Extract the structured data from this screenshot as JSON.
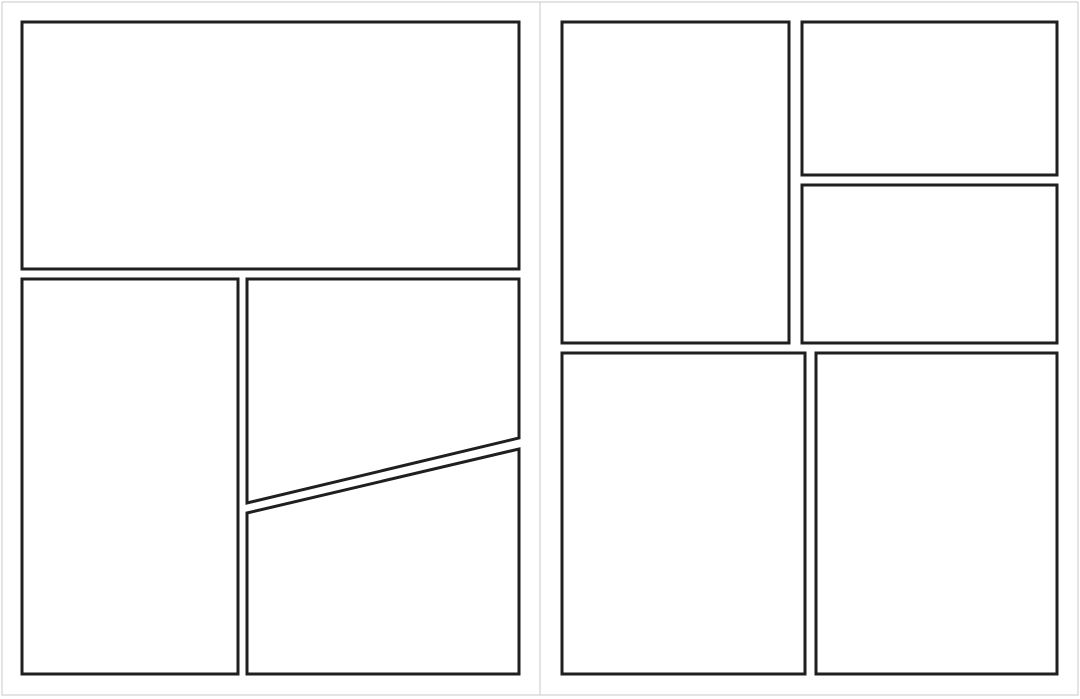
{
  "canvas": {
    "width": 1080,
    "height": 699,
    "background": "#ffffff"
  },
  "colors": {
    "page_background": "#ffffff",
    "page_outline": "#c8c8c8",
    "panel_fill": "#ffffff",
    "panel_border": "#1f1f1f"
  },
  "strokes": {
    "page_outline_width": 1,
    "panel_border_width": 3
  },
  "pages": [
    {
      "id": "page-left",
      "frame": {
        "x": 2,
        "y": 2,
        "w": 538,
        "h": 693
      },
      "panels": [
        {
          "id": "panel-left-top-banner",
          "shape": "rect",
          "points": [
            [
              22,
              22
            ],
            [
              519,
              22
            ],
            [
              519,
              269
            ],
            [
              22,
              269
            ]
          ]
        },
        {
          "id": "panel-left-bottom-left",
          "shape": "rect",
          "points": [
            [
              22,
              279
            ],
            [
              238,
              279
            ],
            [
              238,
              674
            ],
            [
              22,
              674
            ]
          ]
        },
        {
          "id": "panel-left-diagonal-upper",
          "shape": "polygon",
          "points": [
            [
              247,
              279
            ],
            [
              519,
              279
            ],
            [
              519,
              438
            ],
            [
              247,
              503
            ]
          ]
        },
        {
          "id": "panel-left-diagonal-lower",
          "shape": "polygon",
          "points": [
            [
              247,
              513
            ],
            [
              519,
              449
            ],
            [
              519,
              674
            ],
            [
              247,
              674
            ]
          ]
        }
      ]
    },
    {
      "id": "page-right",
      "frame": {
        "x": 540,
        "y": 2,
        "w": 538,
        "h": 693
      },
      "panels": [
        {
          "id": "panel-right-top-tall",
          "shape": "rect",
          "points": [
            [
              562,
              22
            ],
            [
              789,
              22
            ],
            [
              789,
              343
            ],
            [
              562,
              343
            ]
          ]
        },
        {
          "id": "panel-right-top-stack-1",
          "shape": "rect",
          "points": [
            [
              802,
              22
            ],
            [
              1057,
              22
            ],
            [
              1057,
              175
            ],
            [
              802,
              175
            ]
          ]
        },
        {
          "id": "panel-right-top-stack-2",
          "shape": "rect",
          "points": [
            [
              802,
              185
            ],
            [
              1057,
              185
            ],
            [
              1057,
              343
            ],
            [
              802,
              343
            ]
          ]
        },
        {
          "id": "panel-right-bottom-left",
          "shape": "rect",
          "points": [
            [
              562,
              353
            ],
            [
              805,
              353
            ],
            [
              805,
              674
            ],
            [
              562,
              674
            ]
          ]
        },
        {
          "id": "panel-right-bottom-right",
          "shape": "rect",
          "points": [
            [
              816,
              353
            ],
            [
              1057,
              353
            ],
            [
              1057,
              674
            ],
            [
              816,
              674
            ]
          ]
        }
      ]
    }
  ]
}
